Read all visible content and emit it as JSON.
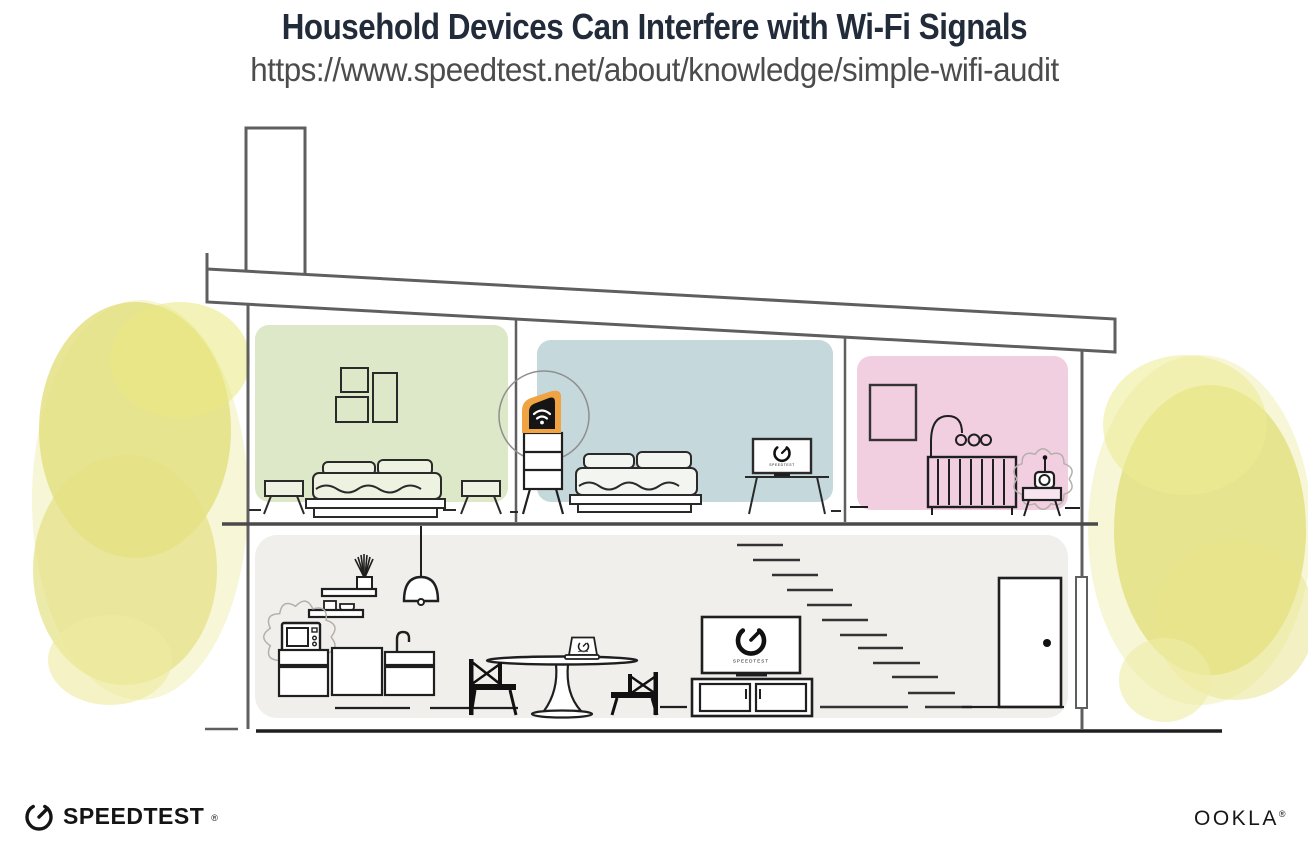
{
  "header": {
    "title": "Household Devices Can Interfere with Wi-Fi Signals",
    "url": "https://www.speedtest.net/about/knowledge/simple-wifi-audit"
  },
  "footer": {
    "speedtest_label": "SPEEDTEST",
    "speedtest_reg": "®",
    "ookla_label": "OOKLA",
    "ookla_reg": "®"
  },
  "illustration": {
    "tv_screen_label": "SPEEDTEST",
    "icons": [
      "wifi-router-icon",
      "speedtest-gauge-icon",
      "microwave-icon",
      "baby-monitor-icon",
      "pendant-lamp-icon",
      "laptop-icon"
    ],
    "colors": {
      "router_highlight": "#f0a343",
      "router_body": "#151515",
      "bedroom_green": "#dce8c8",
      "bedroom_blue": "#c5d8db",
      "nursery_pink": "#f2cee1",
      "downstairs_gray": "#f1efec",
      "foliage_yellow": "#e4e184",
      "foliage_halo": "#f0edb0",
      "structure_gray": "#5f5f5f",
      "ink_black": "#1f1f1f",
      "title_navy": "#222b3a"
    }
  }
}
